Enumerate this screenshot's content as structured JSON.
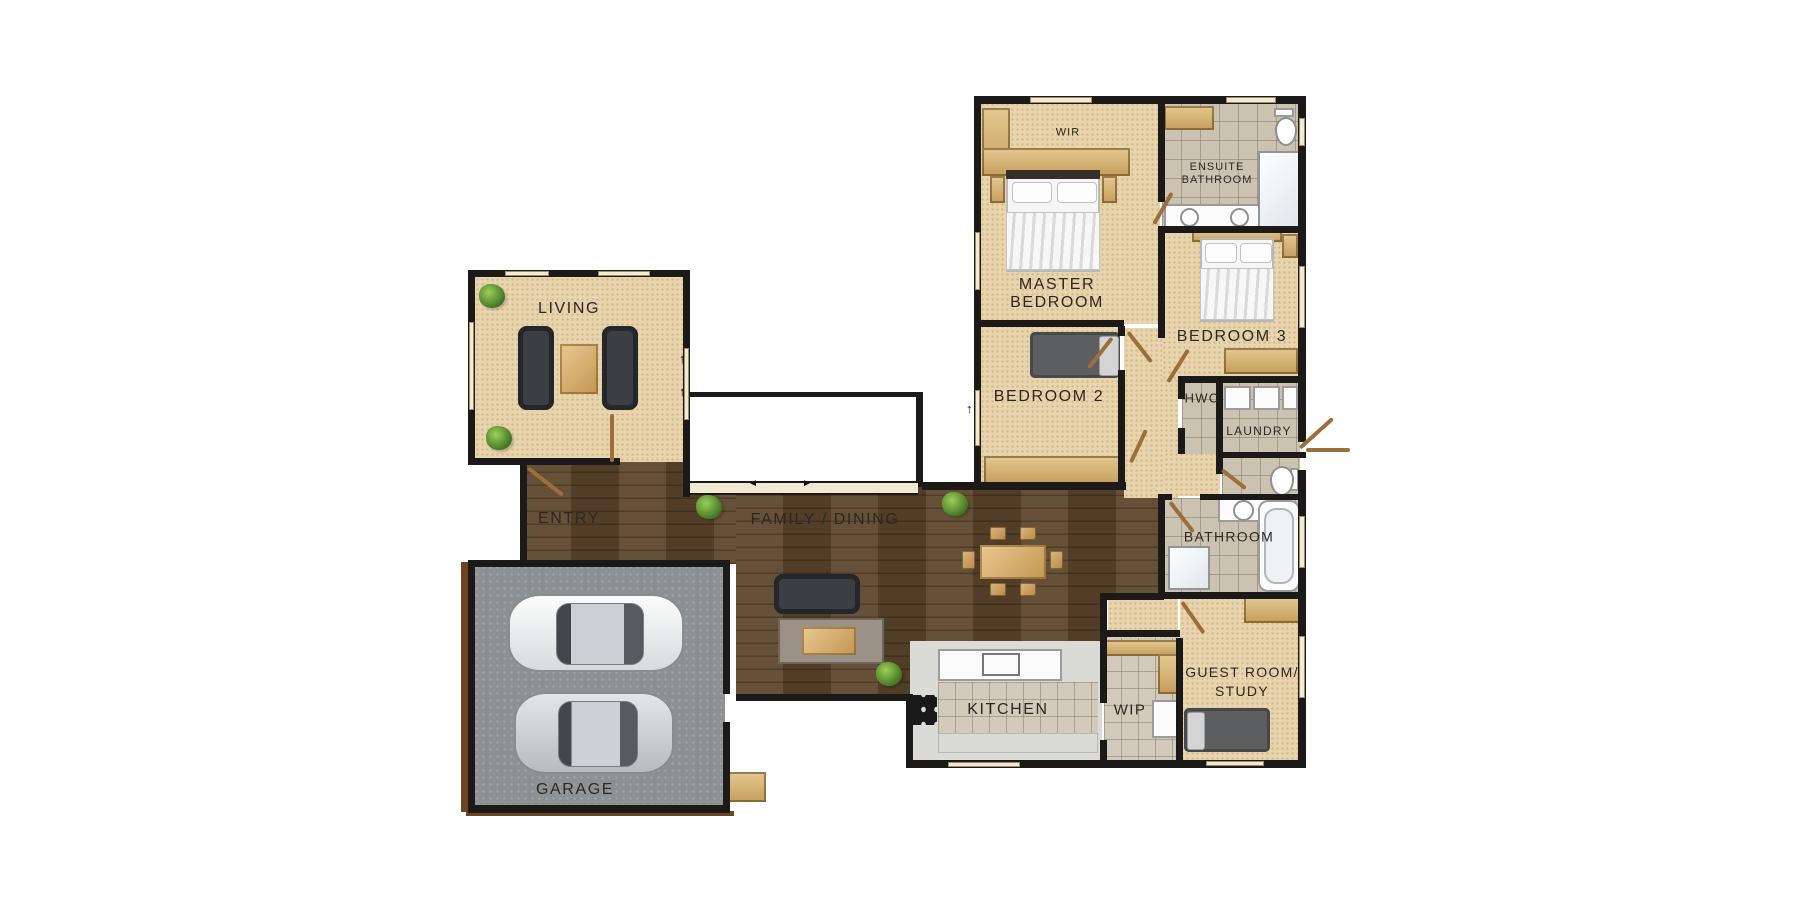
{
  "colors": {
    "wall": "#1c1a18",
    "carpet": "#e8d4ad",
    "timber": "#5d452b",
    "garage": "#8e9193",
    "tile": "#cbc2b2",
    "kitchen": "#dadbd6",
    "window": "#f3ead2",
    "door": "#9c6f3a",
    "label": "#2e2721"
  },
  "rooms": {
    "living": {
      "label": "LIVING"
    },
    "entry": {
      "label": "ENTRY"
    },
    "garage": {
      "label": "GARAGE"
    },
    "family_dining": {
      "label": "FAMILY / DINING"
    },
    "kitchen": {
      "label": "KITCHEN"
    },
    "wip": {
      "label": "WIP"
    },
    "master_bedroom": {
      "line1": "MASTER",
      "line2": "BEDROOM"
    },
    "bedroom2": {
      "label": "BEDROOM 2"
    },
    "bedroom3": {
      "label": "BEDROOM 3"
    },
    "wir": {
      "label": "WIR"
    },
    "ensuite": {
      "line1": "ENSUITE",
      "line2": "BATHROOM"
    },
    "hwc": {
      "label": "HWC"
    },
    "laundry": {
      "label": "LAUNDRY"
    },
    "bathroom": {
      "label": "BATHROOM"
    },
    "guest": {
      "line1": "GUEST ROOM/",
      "line2": "STUDY"
    }
  }
}
